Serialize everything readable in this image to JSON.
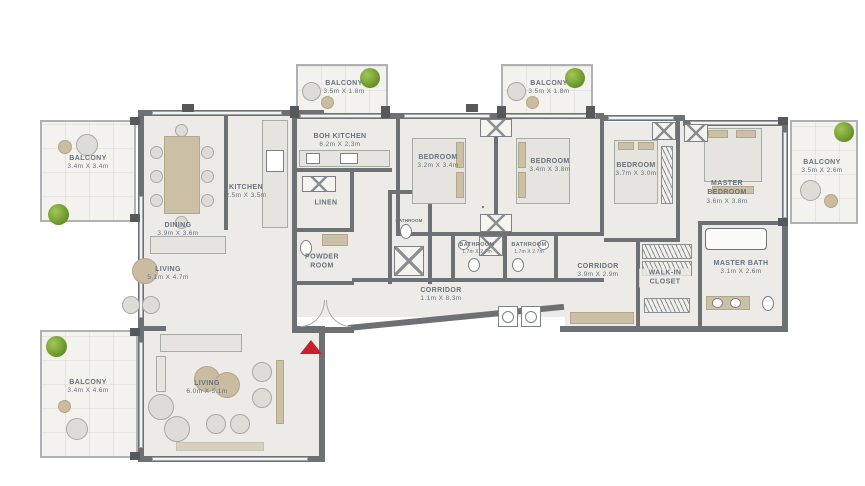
{
  "floorplan": {
    "rooms": {
      "balcony_top_left": {
        "name": "BALCONY",
        "dims": "3.4m X 3.4m"
      },
      "dining": {
        "name": "DINING",
        "dims": "3.9m X 3.6m"
      },
      "kitchen": {
        "name": "KITCHEN",
        "dims": "2.5m X 3.5m"
      },
      "boh_kitchen": {
        "name": "BOH KITCHEN",
        "dims": "6.2m X 2.3m"
      },
      "balcony_top_1": {
        "name": "BALCONY",
        "dims": "3.5m X 1.8m"
      },
      "balcony_top_2": {
        "name": "BALCONY",
        "dims": "3.5m X 1.8m"
      },
      "linen": {
        "name": "LINEN",
        "dims": ""
      },
      "powder_room": {
        "name": "POWDER ROOM",
        "dims": ""
      },
      "bathroom_small": {
        "name": "BATHROOM",
        "dims": ""
      },
      "bedroom_1": {
        "name": "BEDROOM",
        "dims": "3.2m X 3.4m"
      },
      "bedroom_2": {
        "name": "BEDROOM",
        "dims": "3.4m X 3.8m"
      },
      "bathroom_1": {
        "name": "BATHROOM",
        "dims": "1.7m X 2.7m"
      },
      "bathroom_2": {
        "name": "BATHROOM",
        "dims": "1.7m X 2.7m"
      },
      "corridor_1": {
        "name": "CORRIDOR",
        "dims": "1.1m X 8.3m"
      },
      "bedroom_3": {
        "name": "BEDROOM",
        "dims": "3.7m X 3.0m"
      },
      "corridor_2": {
        "name": "CORRIDOR",
        "dims": "3.9m X 2.9m"
      },
      "walk_in_closet": {
        "name": "WALK-IN CLOSET",
        "dims": ""
      },
      "master_bedroom": {
        "name": "MASTER BEDROOM",
        "dims": "3.6m X 3.8m"
      },
      "master_bath": {
        "name": "MASTER BATH",
        "dims": "3.1m X 2.6m"
      },
      "balcony_right": {
        "name": "BALCONY",
        "dims": "3.5m X 2.6m"
      },
      "living_upper": {
        "name": "LIVING",
        "dims": "5.1m X 4.7m"
      },
      "living_lower": {
        "name": "LIVING",
        "dims": "6.0m X 5.1m"
      },
      "balcony_bottom_left": {
        "name": "BALCONY",
        "dims": "3.4m X 4.6m"
      }
    },
    "colors": {
      "wall": "#6d7174",
      "floor": "#edebe7",
      "balcony_floor": "#f3f2ee",
      "label_text": "#67727c",
      "furniture_tan": "#cbbfa6",
      "plant_green": "#6f9a2e",
      "entry_arrow_red": "#c8202a"
    }
  }
}
